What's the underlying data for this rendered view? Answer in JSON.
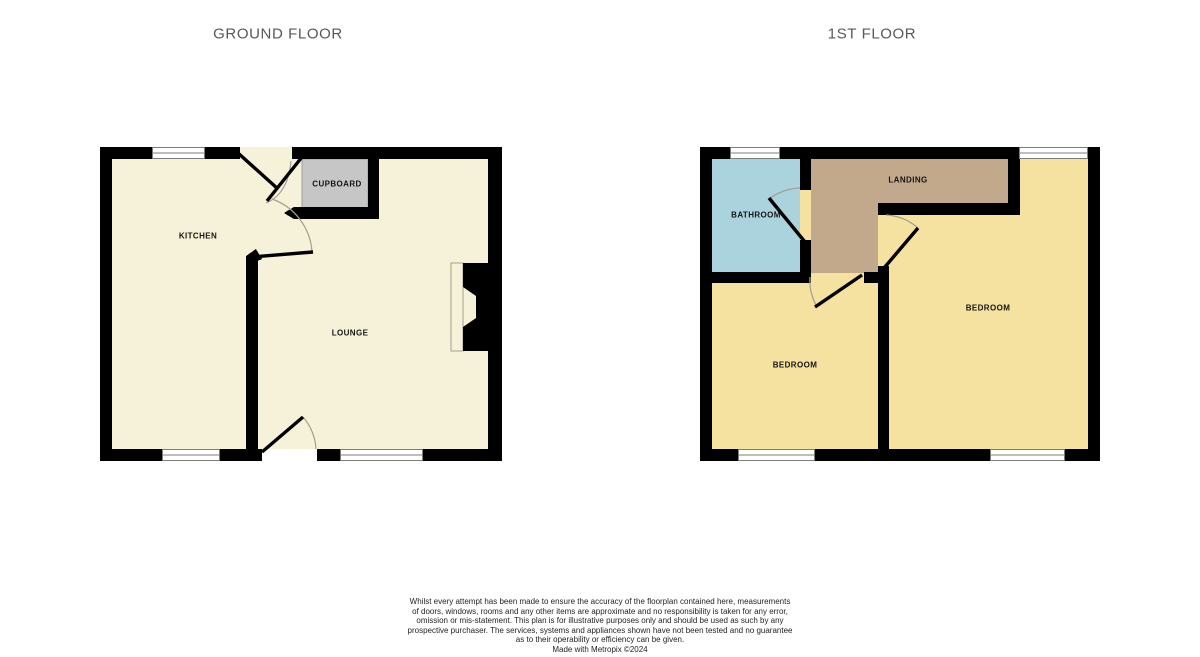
{
  "titles": {
    "ground_floor": "GROUND FLOOR",
    "first_floor": "1ST FLOOR"
  },
  "ground_floor": {
    "rooms": {
      "kitchen": "KITCHEN",
      "cupboard": "CUPBOARD",
      "lounge": "LOUNGE"
    }
  },
  "first_floor": {
    "rooms": {
      "bathroom": "BATHROOM",
      "landing": "LANDING",
      "bedroom_left": "BEDROOM",
      "bedroom_right": "BEDROOM"
    }
  },
  "disclaimer": {
    "lines": [
      "Whilst every attempt has been made to ensure the accuracy of the floorplan contained here, measurements",
      "of doors, windows, rooms and any other items are approximate and no responsibility is taken for any error,",
      "omission or mis-statement. This plan is for illustrative purposes only and should be used as such by any",
      "prospective purchaser. The services, systems and appliances shown have not been tested and no guarantee",
      "as to their operability or efficiency can be given."
    ],
    "credit": "Made with Metropix ©2024"
  },
  "colors": {
    "room_cream": "#F6F1D9",
    "room_yellow": "#F5E2A1",
    "room_blue": "#AAD3DD",
    "room_tan": "#C2A98B",
    "cupboard_gray": "#C6C6C6",
    "wall_black": "#000000",
    "title_gray": "#58585a",
    "label_black": "#141414",
    "arc_gray": "#A39F8F",
    "window_line": "#7c7c7c"
  }
}
